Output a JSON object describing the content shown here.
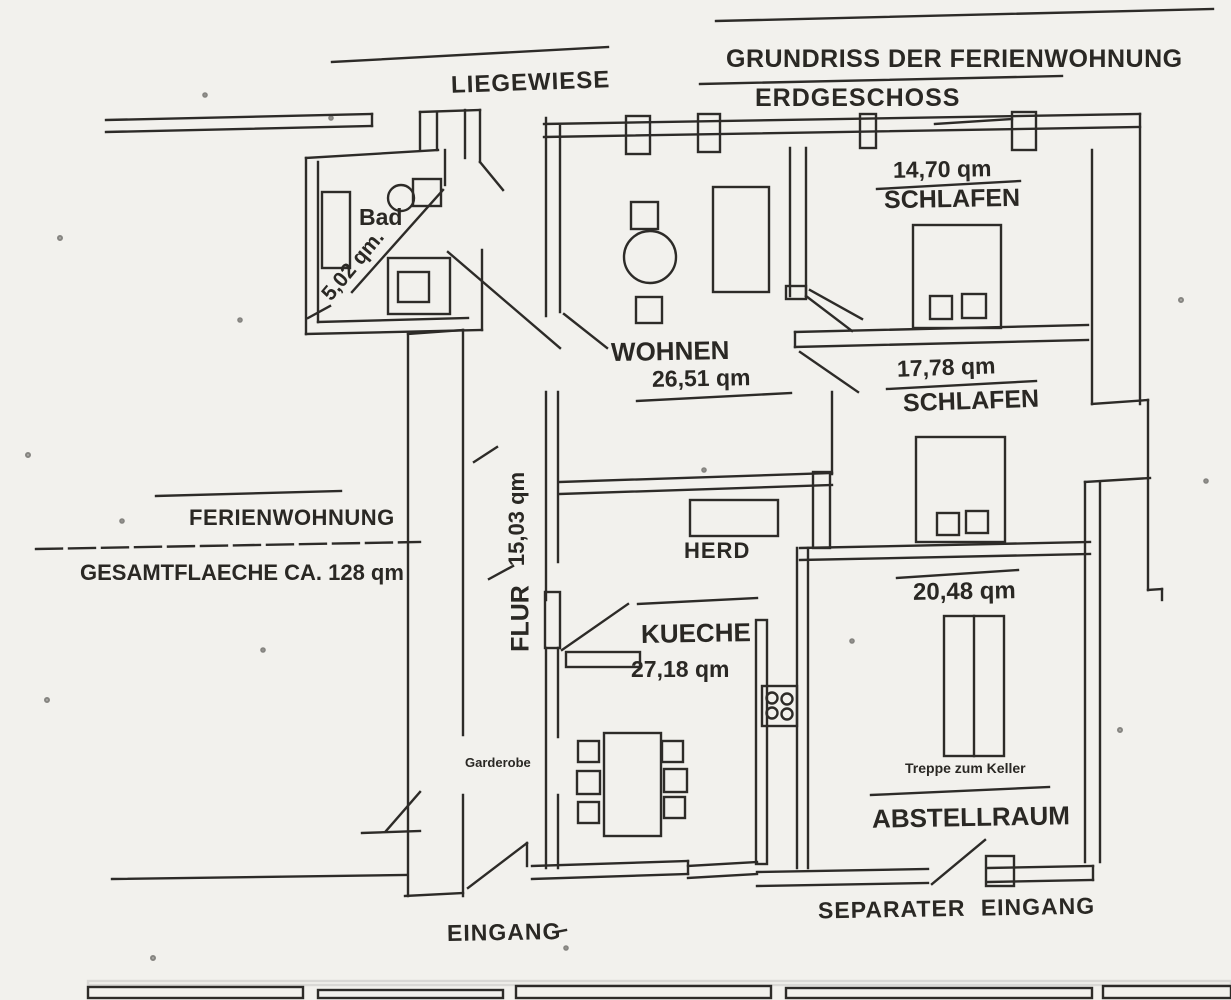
{
  "header": {
    "title": "GRUNDRISS DER FERIENWOHNUNG",
    "floor": "ERDGESCHOSS"
  },
  "outdoor": {
    "lawn_label": "LIEGEWIESE"
  },
  "summary": {
    "name": "FERIENWOHNUNG",
    "total_area": "GESAMTFLAECHE CA. 128 qm"
  },
  "rooms": {
    "bad": {
      "label": "Bad",
      "area": "5,02 qm."
    },
    "wohnen": {
      "label": "WOHNEN",
      "area": "26,51 qm"
    },
    "schlafen_top": {
      "label": "SCHLAFEN",
      "area": "14,70 qm"
    },
    "schlafen_mid": {
      "label": "SCHLAFEN",
      "area": "17,78 qm"
    },
    "flur": {
      "label": "FLUR",
      "area": "15,03 qm"
    },
    "kueche": {
      "label": "KUECHE",
      "area": "27,18 qm"
    },
    "abstellraum": {
      "label": "ABSTELLRAUM",
      "area": "20,48 qm"
    }
  },
  "features": {
    "stove": "HERD",
    "wardrobe": "Garderobe",
    "cellar_stairs": "Treppe zum Keller"
  },
  "entrances": {
    "main": "EINGANG",
    "separate": "SEPARATER EINGANG"
  },
  "colors": {
    "ink": "#2d2b28",
    "paper": "#f2f1ed"
  }
}
